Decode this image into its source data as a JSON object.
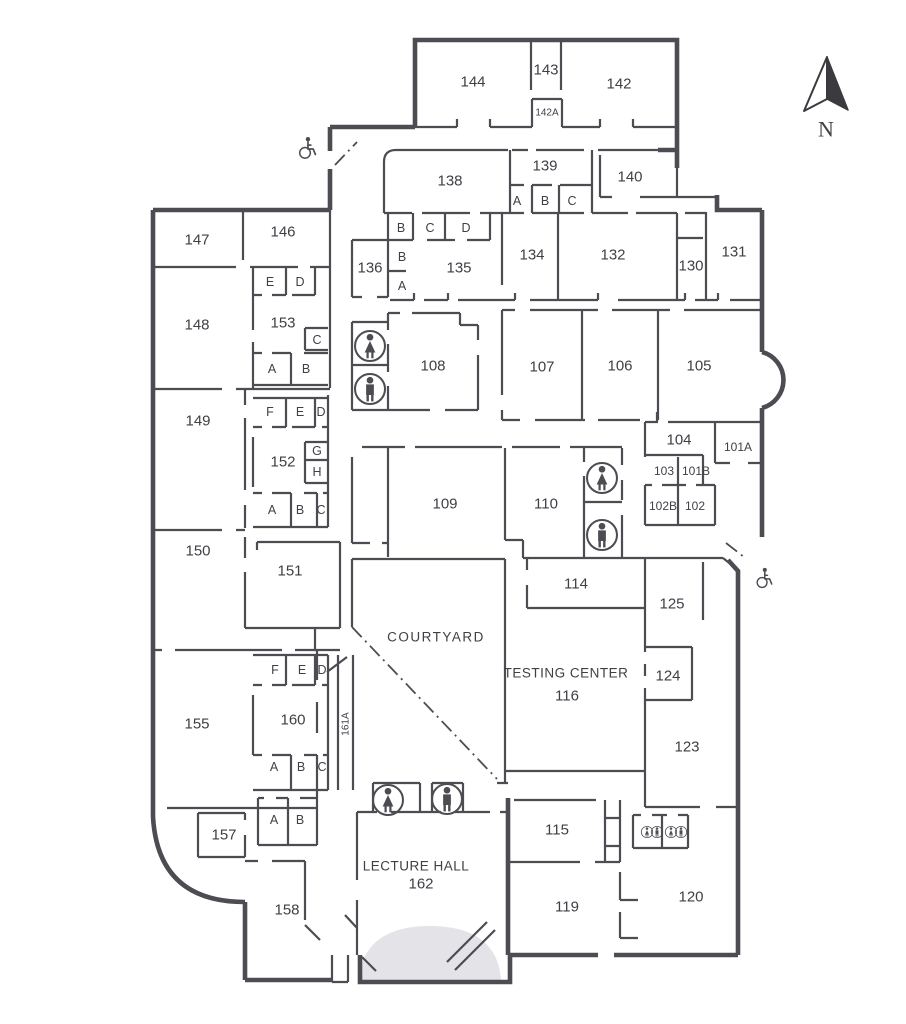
{
  "compass": {
    "label": "N"
  },
  "colors": {
    "wall": "#4c4c52",
    "label": "#3f3f45",
    "stage": "#e4e4e8"
  },
  "labels": [
    {
      "t": "144",
      "x": 473,
      "y": 82
    },
    {
      "t": "143",
      "x": 546,
      "y": 70
    },
    {
      "t": "142",
      "x": 619,
      "y": 84
    },
    {
      "t": "142A",
      "x": 547,
      "y": 113,
      "s": 10
    },
    {
      "t": "138",
      "x": 450,
      "y": 181
    },
    {
      "t": "139",
      "x": 545,
      "y": 166
    },
    {
      "t": "A",
      "x": 517,
      "y": 201,
      "s": 12.5
    },
    {
      "t": "B",
      "x": 545,
      "y": 201,
      "s": 12.5
    },
    {
      "t": "C",
      "x": 572,
      "y": 201,
      "s": 12.5
    },
    {
      "t": "140",
      "x": 630,
      "y": 177
    },
    {
      "t": "147",
      "x": 197,
      "y": 240
    },
    {
      "t": "146",
      "x": 283,
      "y": 232
    },
    {
      "t": "136",
      "x": 370,
      "y": 268
    },
    {
      "t": "B",
      "x": 401,
      "y": 228,
      "s": 12.5
    },
    {
      "t": "C",
      "x": 430,
      "y": 228,
      "s": 12.5
    },
    {
      "t": "D",
      "x": 466,
      "y": 228,
      "s": 12.5
    },
    {
      "t": "B",
      "x": 402,
      "y": 257,
      "s": 12.5
    },
    {
      "t": "A",
      "x": 402,
      "y": 286,
      "s": 12.5
    },
    {
      "t": "135",
      "x": 459,
      "y": 268
    },
    {
      "t": "134",
      "x": 532,
      "y": 255
    },
    {
      "t": "132",
      "x": 613,
      "y": 255
    },
    {
      "t": "130",
      "x": 691,
      "y": 266
    },
    {
      "t": "131",
      "x": 734,
      "y": 252
    },
    {
      "t": "148",
      "x": 197,
      "y": 325
    },
    {
      "t": "E",
      "x": 270,
      "y": 282,
      "s": 12.5
    },
    {
      "t": "D",
      "x": 300,
      "y": 282,
      "s": 12.5
    },
    {
      "t": "153",
      "x": 283,
      "y": 323
    },
    {
      "t": "C",
      "x": 317,
      "y": 340,
      "s": 12.5
    },
    {
      "t": "A",
      "x": 272,
      "y": 369,
      "s": 12.5
    },
    {
      "t": "B",
      "x": 306,
      "y": 369,
      "s": 12.5
    },
    {
      "t": "108",
      "x": 433,
      "y": 366
    },
    {
      "t": "107",
      "x": 542,
      "y": 367
    },
    {
      "t": "106",
      "x": 620,
      "y": 366
    },
    {
      "t": "105",
      "x": 699,
      "y": 366
    },
    {
      "t": "149",
      "x": 198,
      "y": 421
    },
    {
      "t": "F",
      "x": 270,
      "y": 412,
      "s": 12.5
    },
    {
      "t": "E",
      "x": 300,
      "y": 412,
      "s": 12.5
    },
    {
      "t": "D",
      "x": 321,
      "y": 412,
      "s": 12.5
    },
    {
      "t": "152",
      "x": 283,
      "y": 462
    },
    {
      "t": "G",
      "x": 317,
      "y": 451,
      "s": 12.5
    },
    {
      "t": "H",
      "x": 317,
      "y": 472,
      "s": 12.5
    },
    {
      "t": "A",
      "x": 272,
      "y": 510,
      "s": 12.5
    },
    {
      "t": "B",
      "x": 300,
      "y": 510,
      "s": 12.5
    },
    {
      "t": "C",
      "x": 321,
      "y": 510,
      "s": 12.5
    },
    {
      "t": "109",
      "x": 445,
      "y": 504
    },
    {
      "t": "110",
      "x": 546,
      "y": 504
    },
    {
      "t": "104",
      "x": 679,
      "y": 440
    },
    {
      "t": "101A",
      "x": 738,
      "y": 447,
      "s": 12
    },
    {
      "t": "103",
      "x": 664,
      "y": 471,
      "s": 12
    },
    {
      "t": "101B",
      "x": 696,
      "y": 471,
      "s": 12
    },
    {
      "t": "102B",
      "x": 663,
      "y": 506,
      "s": 12
    },
    {
      "t": "102",
      "x": 695,
      "y": 506,
      "s": 12
    },
    {
      "t": "150",
      "x": 198,
      "y": 551
    },
    {
      "t": "151",
      "x": 290,
      "y": 571
    },
    {
      "t": "COURTYARD",
      "x": 436,
      "y": 637,
      "s": 13.5,
      "ls": 1.5
    },
    {
      "t": "114",
      "x": 576,
      "y": 584
    },
    {
      "t": "TESTING CENTER",
      "x": 566,
      "y": 673,
      "s": 13.5,
      "ls": 0.5
    },
    {
      "t": "116",
      "x": 567,
      "y": 696
    },
    {
      "t": "125",
      "x": 672,
      "y": 604
    },
    {
      "t": "124",
      "x": 668,
      "y": 676
    },
    {
      "t": "123",
      "x": 687,
      "y": 747
    },
    {
      "t": "155",
      "x": 197,
      "y": 724
    },
    {
      "t": "F",
      "x": 275,
      "y": 670,
      "s": 12.5
    },
    {
      "t": "E",
      "x": 302,
      "y": 670,
      "s": 12.5
    },
    {
      "t": "D",
      "x": 322,
      "y": 670,
      "s": 12.5
    },
    {
      "t": "160",
      "x": 293,
      "y": 720
    },
    {
      "t": "161A",
      "x": 346,
      "y": 724,
      "s": 10,
      "r": -90
    },
    {
      "t": "A",
      "x": 274,
      "y": 767,
      "s": 12.5
    },
    {
      "t": "B",
      "x": 301,
      "y": 767,
      "s": 12.5
    },
    {
      "t": "C",
      "x": 322,
      "y": 767,
      "s": 12.5
    },
    {
      "t": "157",
      "x": 224,
      "y": 835
    },
    {
      "t": "A",
      "x": 274,
      "y": 820,
      "s": 12.5
    },
    {
      "t": "B",
      "x": 300,
      "y": 820,
      "s": 12.5
    },
    {
      "t": "158",
      "x": 287,
      "y": 910
    },
    {
      "t": "LECTURE HALL",
      "x": 416,
      "y": 866,
      "s": 13.5,
      "ls": 0.5
    },
    {
      "t": "162",
      "x": 421,
      "y": 884
    },
    {
      "t": "115",
      "x": 557,
      "y": 830
    },
    {
      "t": "119",
      "x": 567,
      "y": 907
    },
    {
      "t": "120",
      "x": 691,
      "y": 897
    }
  ],
  "icons": [
    {
      "type": "wheelchair",
      "x": 306,
      "y": 148,
      "s": 26
    },
    {
      "type": "wheelchair",
      "x": 763,
      "y": 578,
      "s": 24
    },
    {
      "type": "female",
      "x": 370,
      "y": 346,
      "s": 37
    },
    {
      "type": "male",
      "x": 370,
      "y": 389,
      "s": 37
    },
    {
      "type": "female",
      "x": 602,
      "y": 478,
      "s": 37
    },
    {
      "type": "male",
      "x": 602,
      "y": 535,
      "s": 37
    },
    {
      "type": "female",
      "x": 388,
      "y": 800,
      "s": 37
    },
    {
      "type": "male",
      "x": 447,
      "y": 799,
      "s": 37
    },
    {
      "type": "female",
      "x": 647,
      "y": 832,
      "s": 14
    },
    {
      "type": "male",
      "x": 657,
      "y": 832,
      "s": 14
    },
    {
      "type": "female",
      "x": 671,
      "y": 832,
      "s": 14
    },
    {
      "type": "male",
      "x": 681,
      "y": 832,
      "s": 14
    }
  ]
}
